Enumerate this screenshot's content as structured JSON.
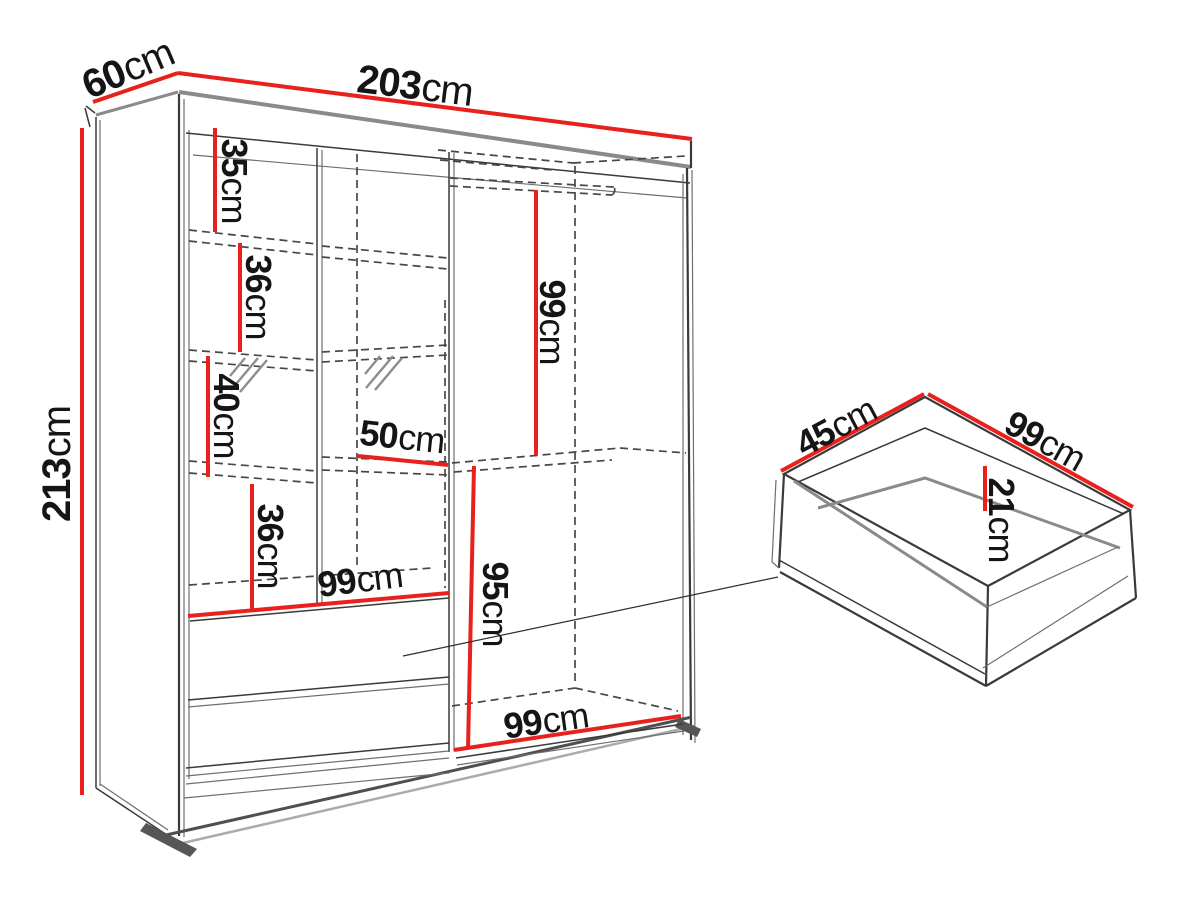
{
  "title": "Wardrobe with sliding doors — dimensions diagram",
  "colors": {
    "dimension_red": "#e8211f",
    "outline_dark": "#3a3a3a",
    "accent_gray": "#8a8a8a",
    "dashed_gray": "#474747",
    "background": "#ffffff"
  },
  "wardrobe": {
    "width": {
      "value": "203",
      "unit": "cm"
    },
    "depth": {
      "value": "60",
      "unit": "cm"
    },
    "height": {
      "value": "213",
      "unit": "cm"
    },
    "shelf_top": {
      "value": "35",
      "unit": "cm"
    },
    "shelf_second": {
      "value": "36",
      "unit": "cm"
    },
    "shelf_mirror": {
      "value": "40",
      "unit": "cm"
    },
    "shelf_fourth": {
      "value": "36",
      "unit": "cm"
    },
    "shelf_section_width": {
      "value": "50",
      "unit": "cm"
    },
    "hanging_height": {
      "value": "99",
      "unit": "cm"
    },
    "lower_section_height": {
      "value": "95",
      "unit": "cm"
    },
    "drawers_width": {
      "value": "99",
      "unit": "cm"
    },
    "right_door_width": {
      "value": "99",
      "unit": "cm"
    }
  },
  "drawer": {
    "depth": {
      "value": "45",
      "unit": "cm"
    },
    "width": {
      "value": "99",
      "unit": "cm"
    },
    "height": {
      "value": "21",
      "unit": "cm"
    }
  }
}
